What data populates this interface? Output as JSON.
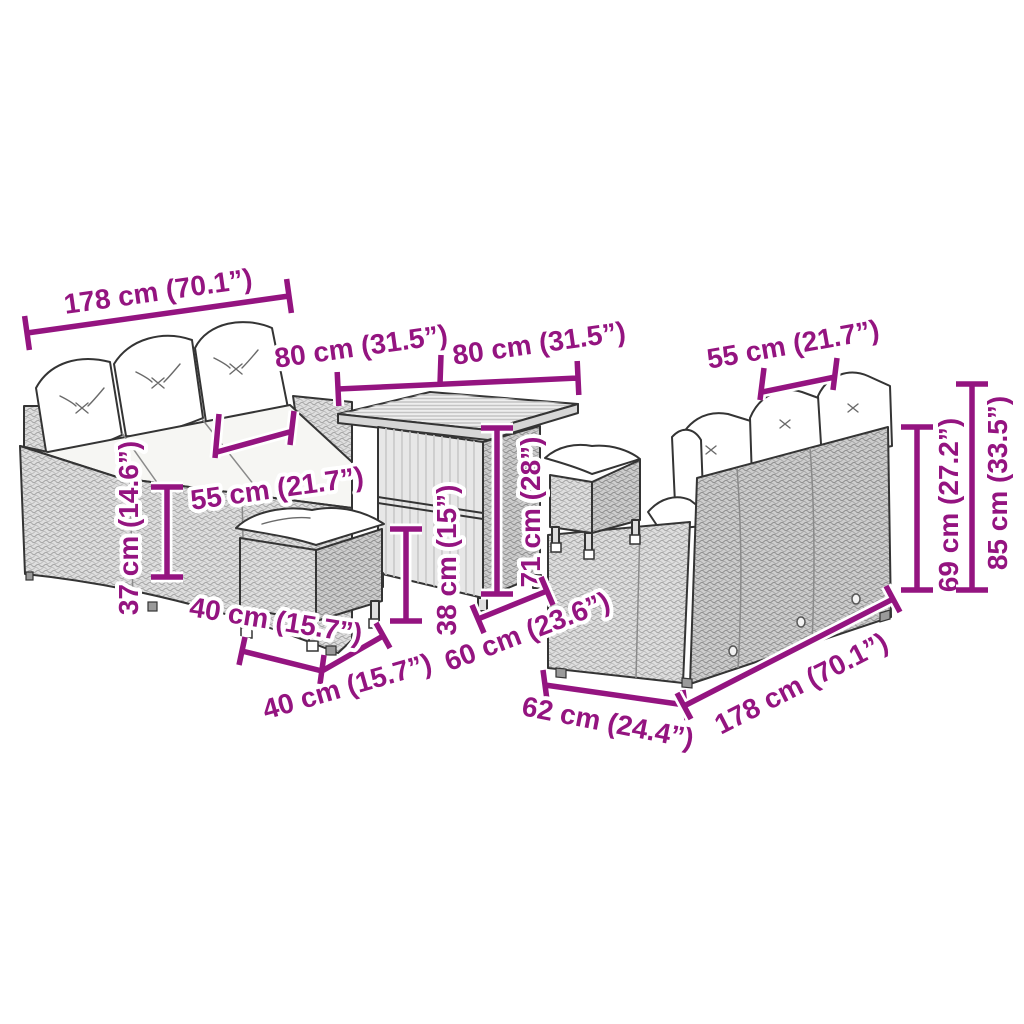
{
  "figure": {
    "kind": "product dimension diagram",
    "furniture": [
      "three-seater sofa with cushions",
      "square storage table",
      "stool with cushion",
      "stool with cushion",
      "three-seater sofa (back view) with cushions"
    ]
  },
  "colors": {
    "accent": "#941480",
    "outline": "#343434",
    "rattan_light": "#dedede",
    "rattan_dark": "#cdcdcd",
    "cushion": "#ffffff",
    "background": "#ffffff"
  },
  "dims": {
    "left_sofa_width": {
      "cm": 178,
      "inch": 70.1,
      "label": "178 cm (70.1”)"
    },
    "table_top_width": {
      "cm": 80,
      "inch": 31.5,
      "label": "80 cm (31.5”)"
    },
    "table_top_depth": {
      "cm": 80,
      "inch": 31.5,
      "label": "80 cm (31.5”)"
    },
    "left_sofa_seat_depth": {
      "cm": 55,
      "inch": 21.7,
      "label": "55 cm (21.7”)"
    },
    "left_sofa_seat_height": {
      "cm": 37,
      "inch": 14.6,
      "label": "37 cm (14.6”)"
    },
    "stool_width": {
      "cm": 40,
      "inch": 15.7,
      "label": "40 cm (15.7”)"
    },
    "stool_depth": {
      "cm": 40,
      "inch": 15.7,
      "label": "40 cm (15.7”)"
    },
    "table_shelf_height": {
      "cm": 38,
      "inch": 15,
      "label": "38 cm (15”)"
    },
    "table_height": {
      "cm": 71,
      "inch": 28,
      "label": "71 cm (28”)"
    },
    "table_base_depth": {
      "cm": 60,
      "inch": 23.6,
      "label": "60 cm (23.6”)"
    },
    "right_sofa_depth": {
      "cm": 62,
      "inch": 24.4,
      "label": "62 cm (24.4”)"
    },
    "right_sofa_width": {
      "cm": 178,
      "inch": 70.1,
      "label": "178 cm (70.1”)"
    },
    "right_sofa_seat_width": {
      "cm": 55,
      "inch": 21.7,
      "label": "55 cm (21.7”)"
    },
    "right_sofa_back_height": {
      "cm": 69,
      "inch": 27.2,
      "label": "69 cm (27.2”)"
    },
    "right_sofa_total_height": {
      "cm": 85,
      "inch": 33.5,
      "label": "85 cm (33.5”)"
    }
  }
}
